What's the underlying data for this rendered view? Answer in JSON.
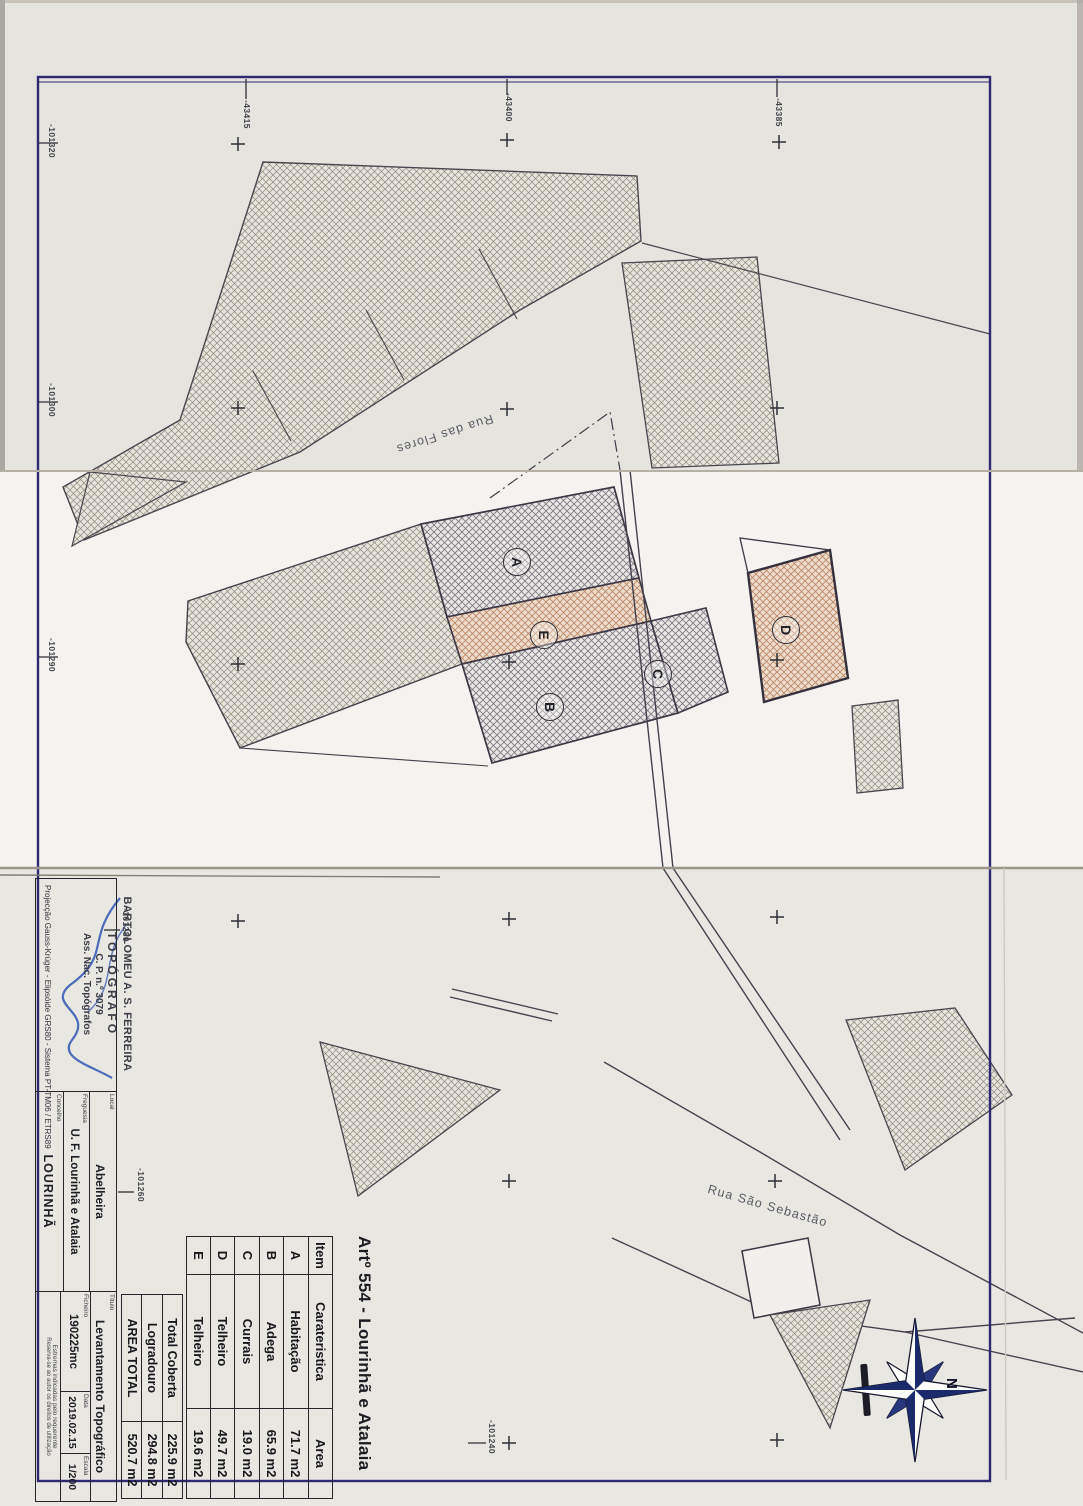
{
  "sheet": {
    "art_title": "Artº 554 - Lourinhã e Atalaia"
  },
  "areas_table": {
    "headers": {
      "item": "Item",
      "carateristica": "Carateristica",
      "area": "Area"
    },
    "rows": [
      {
        "item": "A",
        "carateristica": "Habitação",
        "area": "71.7 m2"
      },
      {
        "item": "B",
        "carateristica": "Adega",
        "area": "65.9 m2"
      },
      {
        "item": "C",
        "carateristica": "Currais",
        "area": "19.0 m2"
      },
      {
        "item": "D",
        "carateristica": "Telheiro",
        "area": "49.7 m2"
      },
      {
        "item": "E",
        "carateristica": "Telheiro",
        "area": "19.6 m2"
      }
    ],
    "totals": [
      {
        "label": "Total Coberta",
        "value": "225.9 m2"
      },
      {
        "label": "Logradouro",
        "value": "294.8 m2"
      },
      {
        "label": "AREA TOTAL",
        "value": "520.7 m2"
      }
    ]
  },
  "title_block": {
    "stamp": {
      "line1": "BARTOLOMEU A. S. FERREIRA",
      "line2": "TOPÓGRAFO",
      "line3": "C. P. n.º 3079",
      "line4": "Ass. Nac. Topógrafos"
    },
    "projection": "Projecção Gauss-Krüger - Elipsóide GRS80 - Sistema PT-TM06 / ETRS89",
    "local": {
      "label": "Local",
      "value": "Abelheira"
    },
    "freguesia": {
      "label": "Freguesia",
      "value": "U. F. Lourinhã e Atalaia"
    },
    "concelho": {
      "label": "Concelho",
      "value": "LOURINHÃ"
    },
    "titulo": {
      "label": "Título",
      "value": "Levantamento Topográfico"
    },
    "ficheiro": {
      "label": "Ficheiro",
      "value": "190225mc"
    },
    "data": {
      "label": "Data",
      "value": "2019.02.15"
    },
    "escala": {
      "label": "Escala",
      "value": "1/200"
    },
    "notes": {
      "note1": "Estremas indicadas pelo requerente",
      "note2": "Reserva-se ao autor os direitos de utilização"
    }
  },
  "map": {
    "streets": {
      "rua_das_flores": "Rua das Flores",
      "rua_sao_sebastiao": "Rua São Sebastão"
    },
    "building_labels": {
      "a": "A",
      "b": "B",
      "c": "C",
      "d": "D",
      "e": "E"
    },
    "grid_labels": {
      "top": [
        "-43415",
        "-43400",
        "-43385"
      ],
      "left": [
        "-101320",
        "-101300",
        "-101290"
      ],
      "inner": [
        "-101280",
        "-101260",
        "-101240"
      ]
    },
    "compass": {
      "north": "N"
    },
    "colors": {
      "frame": "#2e2a72",
      "ink": "#45414e",
      "signature": "#2f55b4",
      "compass": "#1b2a6b",
      "hatch_gray": "#8f897c",
      "hatch_slate": "#7d7884",
      "hatch_orange": "#bd8666"
    }
  }
}
